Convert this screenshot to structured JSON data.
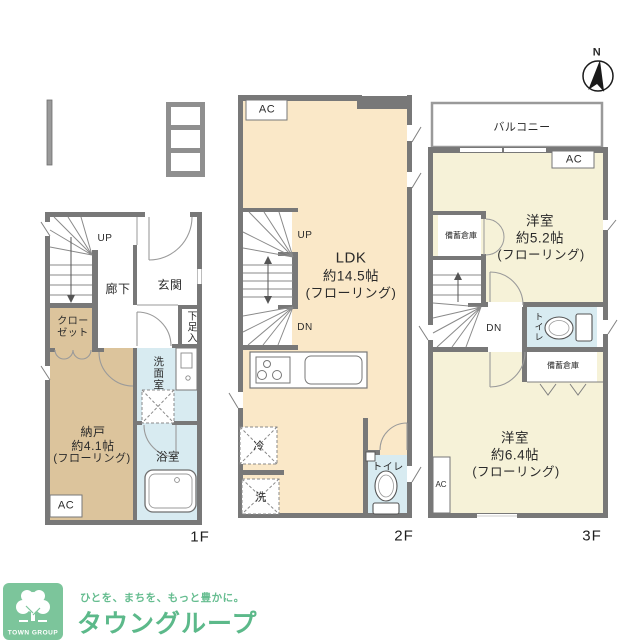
{
  "colors": {
    "wall": "#787878",
    "floor_cream": "#FAE8C8",
    "floor_tan": "#DCC49C",
    "floor_pale_yellow": "#F6F2D8",
    "water_blue": "#D8EBF1",
    "logo_green": "#7CC59B",
    "brand_green": "#5CB98A"
  },
  "compass": {
    "north": "N"
  },
  "floor1": {
    "floor_label": "1F",
    "up": "UP",
    "hallway": "廊下",
    "entrance": "玄関",
    "shoe_cabinet": "下足入",
    "closet_line1": "クロー",
    "closet_line2": "ゼット",
    "storage_name": "納戸",
    "storage_size": "約4.1帖",
    "storage_floor": "(フローリング)",
    "ac": "AC",
    "washroom": "洗面室",
    "bathroom": "浴室"
  },
  "floor2": {
    "floor_label": "2F",
    "ac": "AC",
    "up": "UP",
    "dn": "DN",
    "ldk_name": "LDK",
    "ldk_size": "約14.5帖",
    "ldk_floor": "(フローリング)",
    "fridge": "冷",
    "washer": "洗",
    "toilet": "トイレ"
  },
  "floor3": {
    "floor_label": "3F",
    "balcony": "バルコニー",
    "ac_upper": "AC",
    "ac_lower": "AC",
    "storage_upper": "備蓄倉庫",
    "storage_lower": "備蓄倉庫",
    "room_upper_name": "洋室",
    "room_upper_size": "約5.2帖",
    "room_upper_floor": "(フローリング)",
    "dn": "DN",
    "toilet": "トイレ",
    "room_lower_name": "洋室",
    "room_lower_size": "約6.4帖",
    "room_lower_floor": "(フローリング)"
  },
  "footer": {
    "tagline": "ひとを、まちを、もっと豊かに。",
    "brand_name": "タウングループ",
    "logo_text": "TOWN GROUP"
  }
}
